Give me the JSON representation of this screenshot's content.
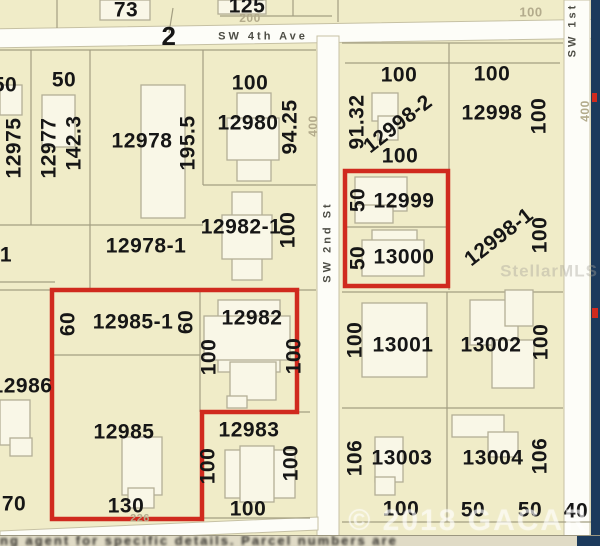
{
  "map": {
    "colors": {
      "parcel_bg": "#f0ecc8",
      "street": "#fdfdf8",
      "street_edge": "#c6c1a4",
      "boundary": "#a39e82",
      "building_fill": "#f9f7e7",
      "building_edge": "#b3ae96",
      "highlight_red": "#d02a1e",
      "edge_navy": "#1c3a5c",
      "text": "#161616",
      "dim_text": "#b3ab8c"
    },
    "streets": [
      {
        "name": "SW 4th Ave",
        "x": -10,
        "y": 24,
        "w": 620,
        "h": 19,
        "rot": -0.9
      },
      {
        "name": "SW 2nd St",
        "x": 317,
        "y": 36,
        "w": 22,
        "h": 501,
        "rot": 0
      },
      {
        "name": "SW 1st St",
        "x": 564,
        "y": 0,
        "w": 26,
        "h": 537,
        "rot": 0
      }
    ],
    "diagonal_street_points": "0,531 318,517 318,530 0,544",
    "boundaries": [
      [
        57,
        0,
        57,
        28
      ],
      [
        173,
        8,
        169,
        33
      ],
      [
        293,
        0,
        293,
        16
      ],
      [
        220,
        16,
        332,
        16
      ],
      [
        338,
        0,
        338,
        22
      ],
      [
        0,
        50,
        316,
        50
      ],
      [
        31,
        50,
        31,
        225
      ],
      [
        90,
        50,
        90,
        290
      ],
      [
        203,
        50,
        203,
        185
      ],
      [
        203,
        185,
        316,
        185
      ],
      [
        0,
        225,
        203,
        225
      ],
      [
        0,
        282,
        55,
        282
      ],
      [
        0,
        290,
        316,
        290
      ],
      [
        52,
        290,
        52,
        518
      ],
      [
        52,
        355,
        200,
        355
      ],
      [
        200,
        290,
        200,
        412
      ],
      [
        297,
        290,
        297,
        412
      ],
      [
        200,
        412,
        310,
        412
      ],
      [
        52,
        518,
        310,
        518
      ],
      [
        342,
        43,
        563,
        43
      ],
      [
        345,
        63,
        560,
        63
      ],
      [
        449,
        43,
        449,
        290
      ],
      [
        344,
        170,
        449,
        170
      ],
      [
        347,
        227,
        448,
        227
      ],
      [
        342,
        292,
        563,
        292
      ],
      [
        342,
        408,
        563,
        408
      ],
      [
        447,
        292,
        447,
        522
      ],
      [
        342,
        522,
        600,
        522
      ]
    ],
    "buildings": [
      [
        0,
        85,
        22,
        30
      ],
      [
        42,
        95,
        33,
        52
      ],
      [
        141,
        85,
        44,
        133
      ],
      [
        237,
        93,
        34,
        88
      ],
      [
        227,
        118,
        52,
        42
      ],
      [
        232,
        192,
        30,
        88
      ],
      [
        222,
        215,
        50,
        44
      ],
      [
        218,
        300,
        62,
        72
      ],
      [
        204,
        316,
        86,
        44
      ],
      [
        230,
        362,
        46,
        38
      ],
      [
        227,
        396,
        20,
        12
      ],
      [
        122,
        437,
        40,
        58
      ],
      [
        128,
        488,
        26,
        20
      ],
      [
        0,
        400,
        30,
        45
      ],
      [
        10,
        438,
        22,
        18
      ],
      [
        225,
        450,
        70,
        48
      ],
      [
        240,
        446,
        34,
        56
      ],
      [
        355,
        177,
        52,
        34
      ],
      [
        355,
        205,
        38,
        18
      ],
      [
        372,
        230,
        45,
        16
      ],
      [
        362,
        240,
        62,
        36
      ],
      [
        372,
        93,
        26,
        28
      ],
      [
        378,
        116,
        20,
        24
      ],
      [
        362,
        303,
        65,
        74
      ],
      [
        470,
        300,
        48,
        45
      ],
      [
        505,
        290,
        28,
        36
      ],
      [
        492,
        340,
        42,
        48
      ],
      [
        375,
        437,
        28,
        45
      ],
      [
        375,
        477,
        20,
        18
      ],
      [
        452,
        415,
        52,
        22
      ],
      [
        488,
        432,
        30,
        25
      ],
      [
        100,
        0,
        50,
        20
      ],
      [
        218,
        0,
        48,
        14
      ]
    ],
    "highlight_polygon_points": "52,290 297,290 297,412 202,412 202,519 52,519",
    "highlight_rect": {
      "x": 345,
      "y": 171,
      "w": 103,
      "h": 115
    },
    "navy_rects": [
      [
        591,
        0,
        9,
        546
      ]
    ],
    "red_marks": [
      [
        592,
        93,
        5,
        9
      ],
      [
        592,
        308,
        6,
        10
      ]
    ],
    "labels": [
      {
        "t": "73",
        "x": 126,
        "y": 10
      },
      {
        "t": "125",
        "x": 247,
        "y": 6
      },
      {
        "t": "200",
        "x": 250,
        "y": 18,
        "c": "dim",
        "s": 12
      },
      {
        "t": "2",
        "x": 169,
        "y": 36,
        "s": 26
      },
      {
        "t": "SW 4th Ave",
        "x": 263,
        "y": 37,
        "c": "street",
        "s": 11
      },
      {
        "t": "100",
        "x": 531,
        "y": 12,
        "c": "dim",
        "s": 13
      },
      {
        "t": "SW 1st",
        "x": 573,
        "y": 30,
        "r": -90,
        "c": "street",
        "s": 11
      },
      {
        "t": "50",
        "x": 5,
        "y": 85
      },
      {
        "t": "50",
        "x": 64,
        "y": 80
      },
      {
        "t": "12975",
        "x": 14,
        "y": 148,
        "r": -90
      },
      {
        "t": "12977",
        "x": 49,
        "y": 148,
        "r": -90
      },
      {
        "t": "142.3",
        "x": 74,
        "y": 143,
        "r": -90
      },
      {
        "t": "12978",
        "x": 142,
        "y": 141
      },
      {
        "t": "195.5",
        "x": 188,
        "y": 143,
        "r": -90
      },
      {
        "t": "100",
        "x": 250,
        "y": 83
      },
      {
        "t": "12980",
        "x": 248,
        "y": 123
      },
      {
        "t": "94.25",
        "x": 290,
        "y": 127,
        "r": -90
      },
      {
        "t": "400",
        "x": 313,
        "y": 126,
        "r": -90,
        "c": "dim",
        "s": 12
      },
      {
        "t": "12982-1",
        "x": 241,
        "y": 227
      },
      {
        "t": "100",
        "x": 288,
        "y": 230,
        "r": -90
      },
      {
        "t": "12978-1",
        "x": 146,
        "y": 246
      },
      {
        "t": "1",
        "x": 6,
        "y": 255
      },
      {
        "t": "SW 2nd St",
        "x": 328,
        "y": 242,
        "r": -90,
        "c": "street",
        "s": 11
      },
      {
        "t": "100",
        "x": 399,
        "y": 75
      },
      {
        "t": "91.32",
        "x": 357,
        "y": 122,
        "r": -90
      },
      {
        "t": "12998-2",
        "x": 398,
        "y": 124,
        "r": -38
      },
      {
        "t": "100",
        "x": 400,
        "y": 156
      },
      {
        "t": "100",
        "x": 492,
        "y": 74
      },
      {
        "t": "12998",
        "x": 492,
        "y": 113
      },
      {
        "t": "100",
        "x": 539,
        "y": 116,
        "r": -90
      },
      {
        "t": "50",
        "x": 358,
        "y": 200,
        "r": -90
      },
      {
        "t": "12999",
        "x": 404,
        "y": 201
      },
      {
        "t": "50",
        "x": 358,
        "y": 258,
        "r": -90
      },
      {
        "t": "13000",
        "x": 404,
        "y": 257
      },
      {
        "t": "12998-1",
        "x": 499,
        "y": 237,
        "r": -38
      },
      {
        "t": "100",
        "x": 540,
        "y": 235,
        "r": -90
      },
      {
        "t": "400",
        "x": 585,
        "y": 111,
        "r": -90,
        "c": "dim",
        "s": 12
      },
      {
        "t": "StellarMLS",
        "x": 549,
        "y": 271,
        "c": "wm-mls",
        "s": 17
      },
      {
        "t": "60",
        "x": 68,
        "y": 324,
        "r": -90
      },
      {
        "t": "12985-1",
        "x": 133,
        "y": 322
      },
      {
        "t": "60",
        "x": 186,
        "y": 322,
        "r": -90
      },
      {
        "t": "12982",
        "x": 252,
        "y": 318
      },
      {
        "t": "100",
        "x": 209,
        "y": 357,
        "r": -90
      },
      {
        "t": "100",
        "x": 294,
        "y": 356,
        "r": -90
      },
      {
        "t": "12986",
        "x": 22,
        "y": 386
      },
      {
        "t": "100",
        "x": 355,
        "y": 340,
        "r": -90
      },
      {
        "t": "13001",
        "x": 403,
        "y": 345
      },
      {
        "t": "13002",
        "x": 491,
        "y": 345
      },
      {
        "t": "100",
        "x": 541,
        "y": 342,
        "r": -90
      },
      {
        "t": "12985",
        "x": 124,
        "y": 432
      },
      {
        "t": "12983",
        "x": 249,
        "y": 430
      },
      {
        "t": "100",
        "x": 208,
        "y": 466,
        "r": -90
      },
      {
        "t": "100",
        "x": 291,
        "y": 463,
        "r": -90
      },
      {
        "t": "70",
        "x": 14,
        "y": 504
      },
      {
        "t": "130",
        "x": 126,
        "y": 506
      },
      {
        "t": "226",
        "x": 140,
        "y": 519,
        "c": "dim",
        "s": 11
      },
      {
        "t": "100",
        "x": 248,
        "y": 509
      },
      {
        "t": "106",
        "x": 355,
        "y": 458,
        "r": -90
      },
      {
        "t": "13003",
        "x": 402,
        "y": 458
      },
      {
        "t": "13004",
        "x": 493,
        "y": 458
      },
      {
        "t": "106",
        "x": 540,
        "y": 456,
        "r": -90
      },
      {
        "t": "100",
        "x": 401,
        "y": 509
      },
      {
        "t": "50",
        "x": 473,
        "y": 510
      },
      {
        "t": "50",
        "x": 530,
        "y": 510
      },
      {
        "t": "40",
        "x": 576,
        "y": 511
      },
      {
        "t": "© 2018 GACAR",
        "x": 468,
        "y": 521,
        "c": "wm-c",
        "s": 30
      }
    ],
    "footer": {
      "text": "ng agent for specific details.  Parcel numbers are"
    }
  }
}
